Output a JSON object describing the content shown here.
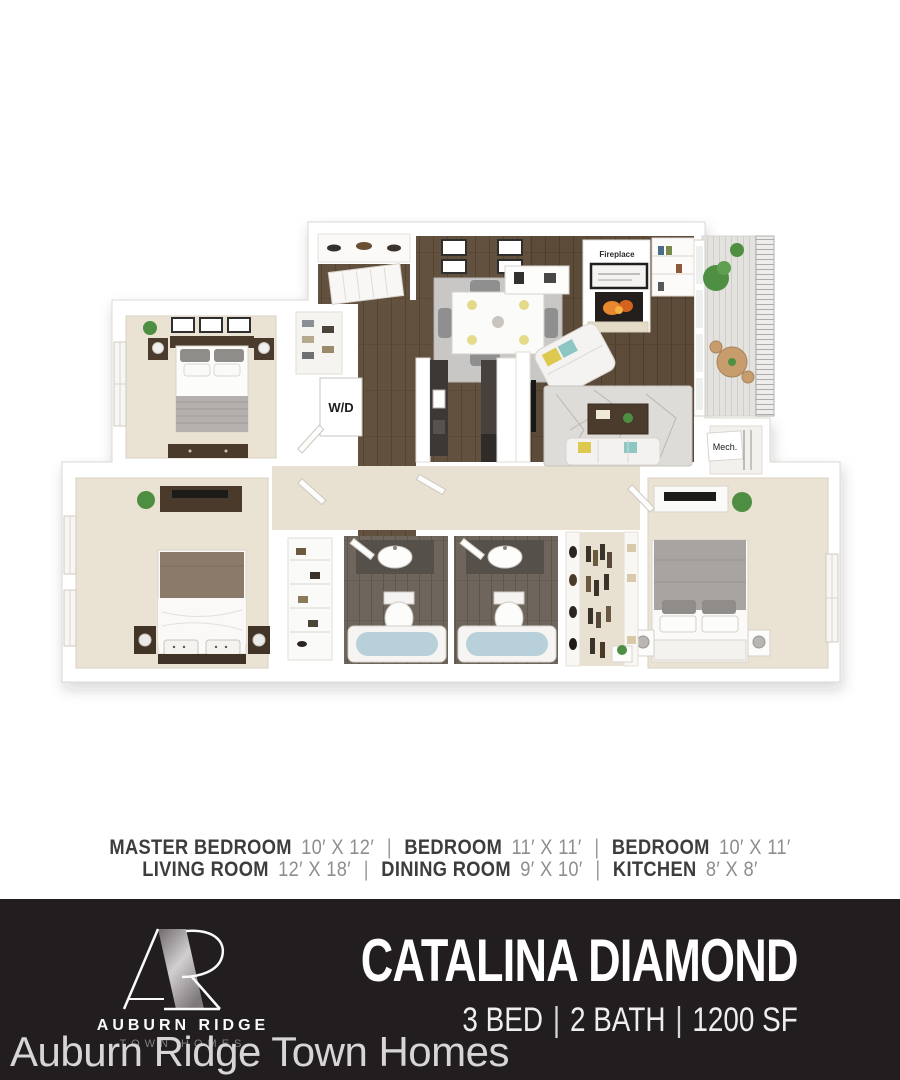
{
  "floor_plan": {
    "labels": {
      "fireplace": "Fireplace",
      "washer_dryer": "W/D",
      "mechanical": "Mech."
    },
    "colors": {
      "carpet": "#eae3d3",
      "wood": "#63513f",
      "bath_floor": "#6e665c",
      "tub_water": "#b7d0d9",
      "wall": "#ffffff"
    }
  },
  "room_dimensions": {
    "separator": "|",
    "line1": [
      {
        "name": "MASTER BEDROOM",
        "size": "10′ X 12′"
      },
      {
        "name": "BEDROOM",
        "size": "11′ X 11′"
      },
      {
        "name": "BEDROOM",
        "size": "10′ X 11′"
      }
    ],
    "line2": [
      {
        "name": "LIVING ROOM",
        "size": "12′ X 18′"
      },
      {
        "name": "DINING ROOM",
        "size": "9′ X 10′"
      },
      {
        "name": "KITCHEN",
        "size": "8′ X 8′"
      }
    ]
  },
  "footer": {
    "brand": {
      "name": "AUBURN RIDGE",
      "tagline": "TOWN HOMES"
    },
    "plan_title": "CATALINA DIAMOND",
    "specs": {
      "beds": "3 BED",
      "baths": "2 BATH",
      "area": "1200 SF",
      "separator": "|"
    },
    "colors": {
      "background": "#221e1f",
      "text": "#ffffff"
    }
  },
  "watermark": {
    "text": "Auburn Ridge Town Homes",
    "color": "#d7d5d5"
  }
}
